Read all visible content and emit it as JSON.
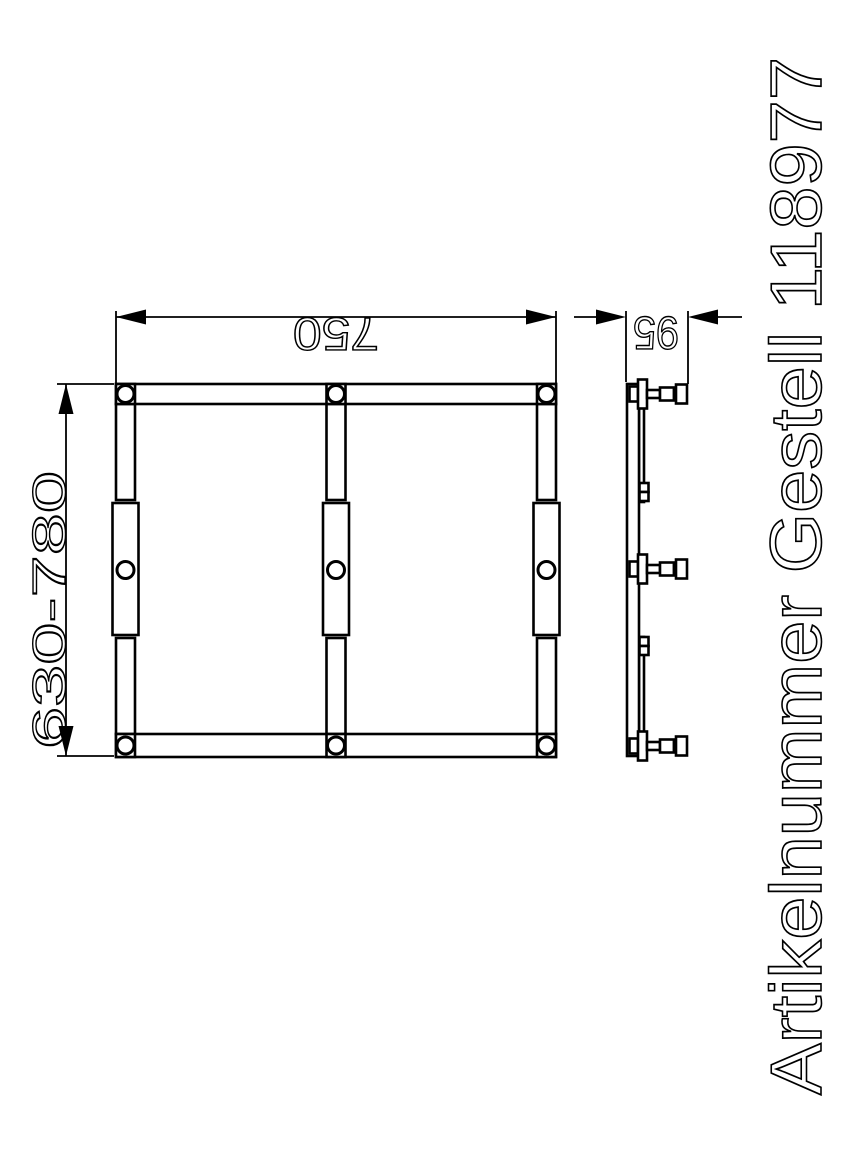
{
  "document": {
    "background_color": "#ffffff",
    "line_color": "#000000",
    "kind": "technical drawing"
  },
  "title": {
    "text": "Artikelnummer Gestell 118977"
  },
  "dimensions": {
    "width": "750",
    "height_range": "630-780",
    "depth": "95"
  },
  "views": {
    "front": {
      "rails": 3,
      "holes": 9,
      "horizontal_bars": 2
    },
    "side": {
      "clamp_knobs": 3,
      "clips": 2
    }
  }
}
